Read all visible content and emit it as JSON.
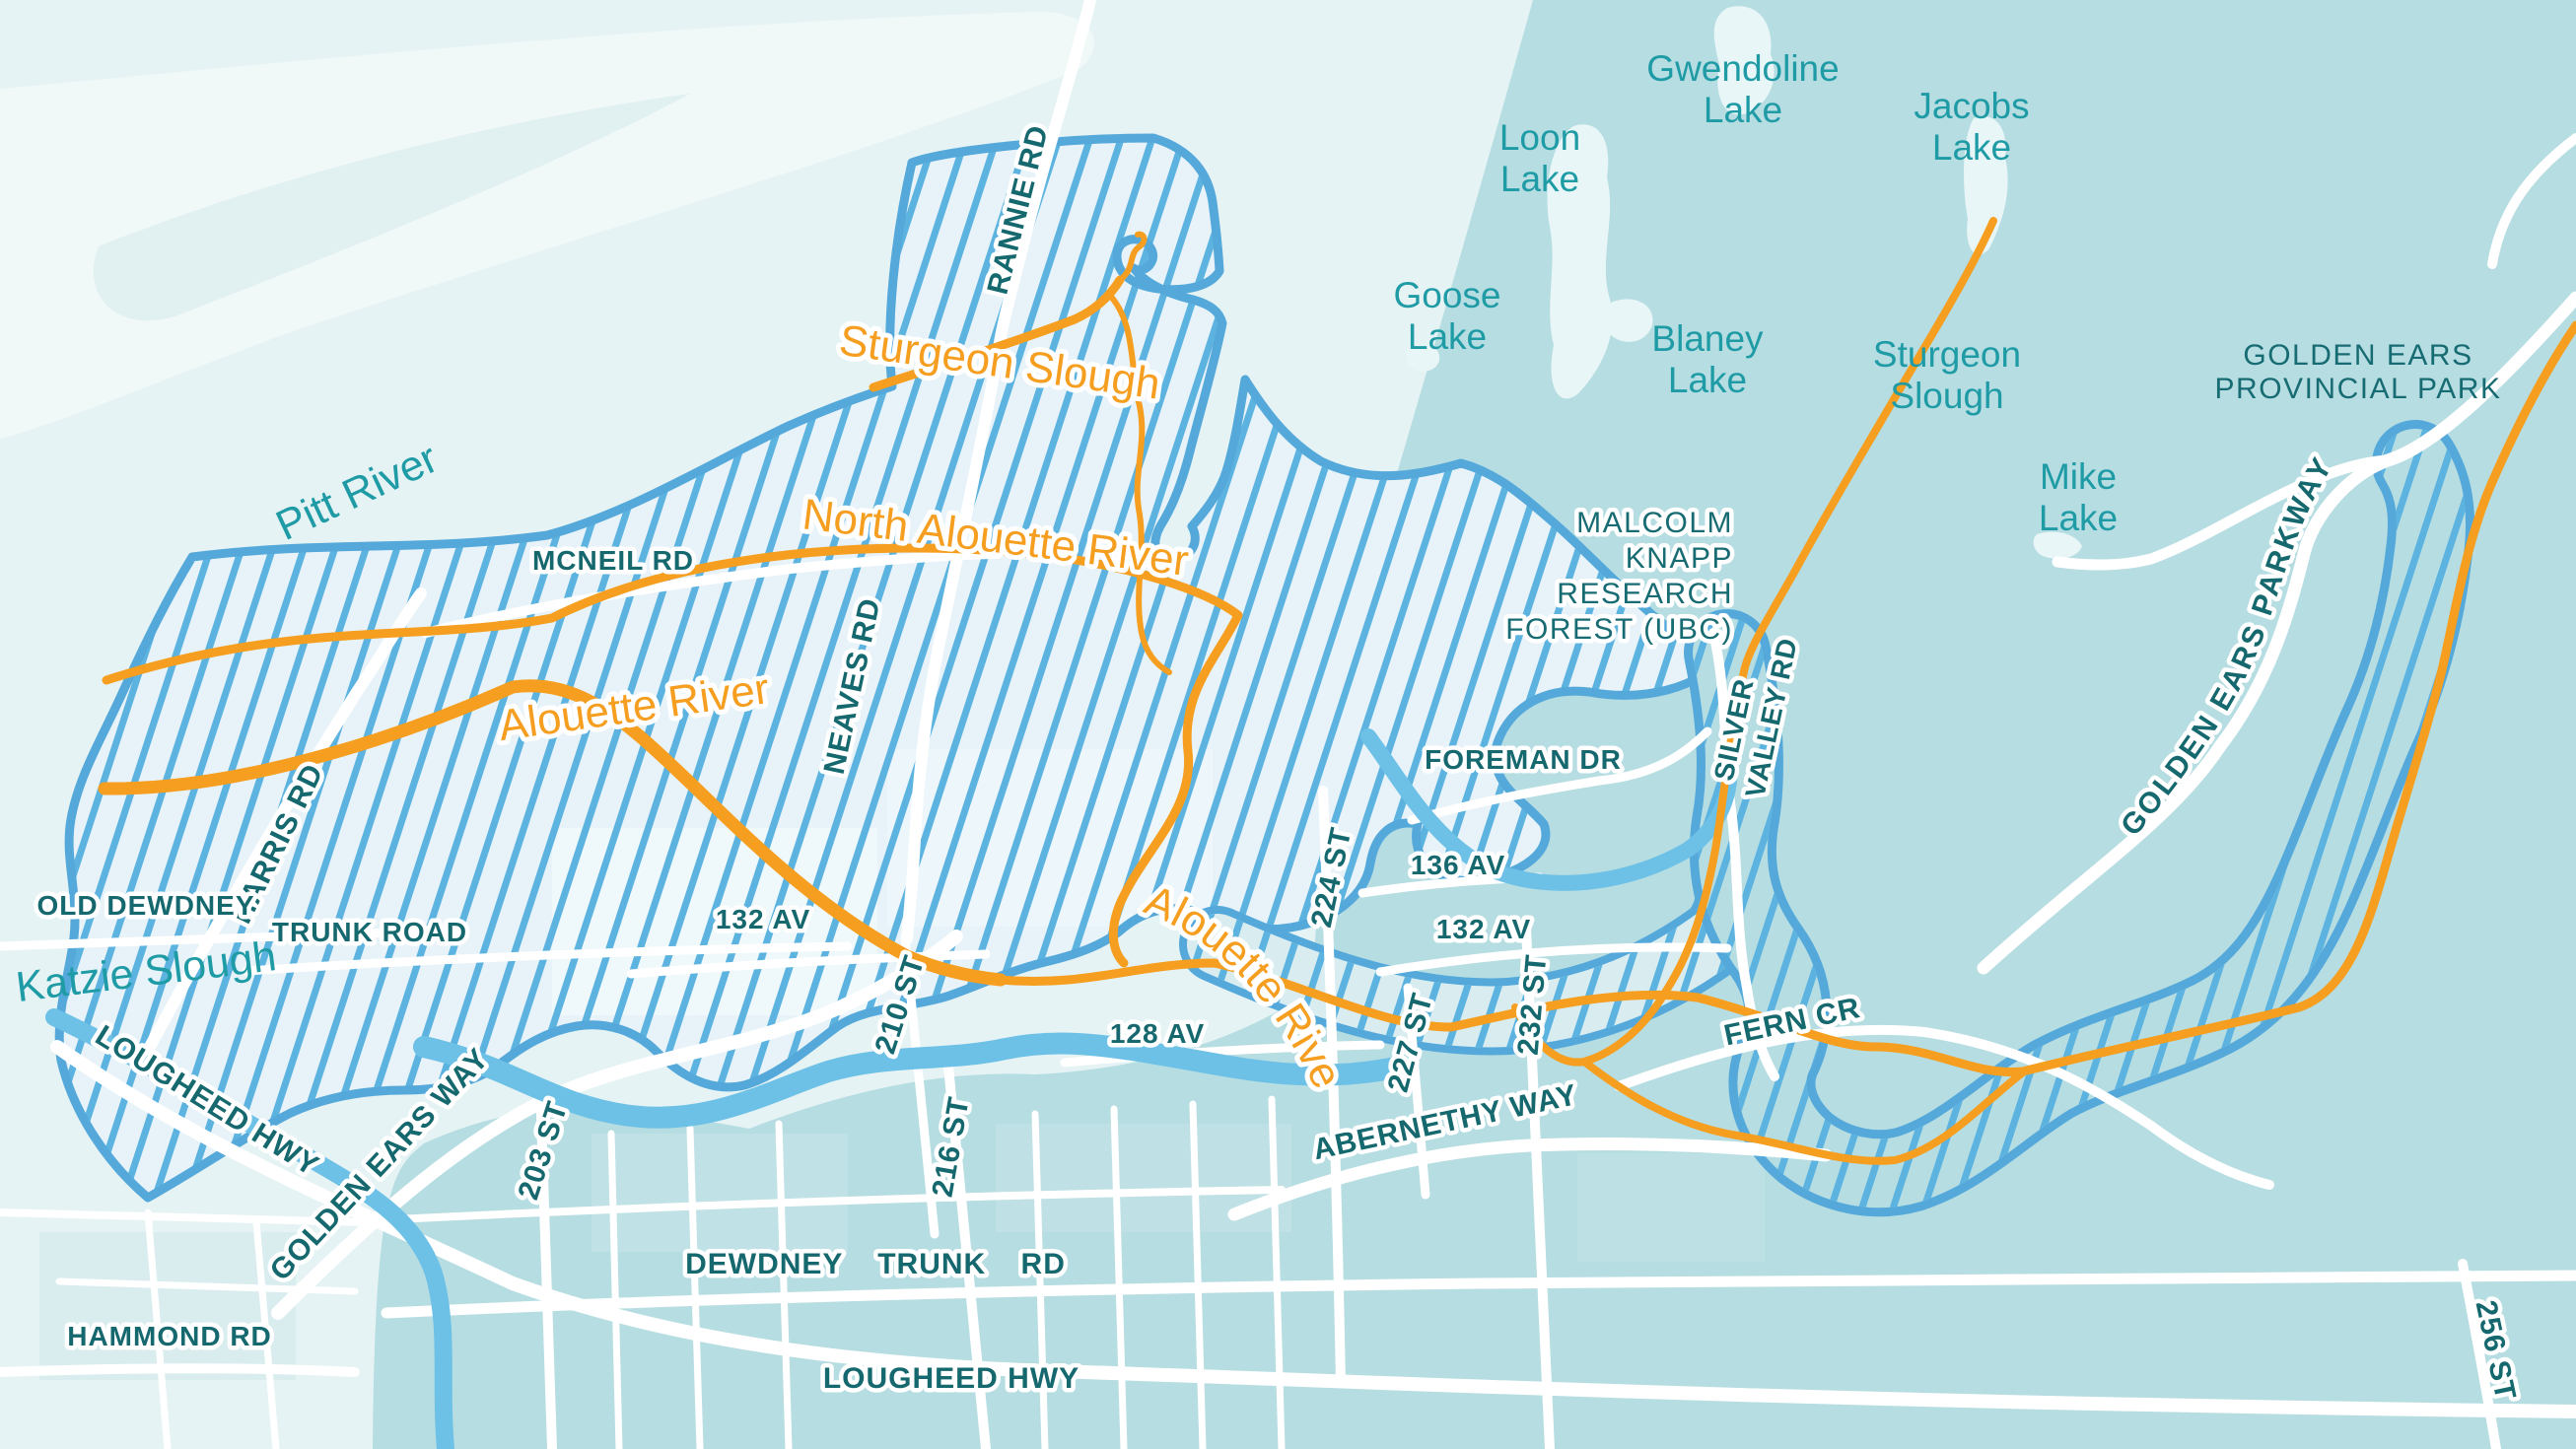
{
  "colors": {
    "zone_dark_teal": "#b6dde2",
    "zone_pale": "#e6f3f4",
    "pitt_river_water": "#f0f8f8",
    "watershed_fill": "#e8f3f9",
    "watershed_hatch_blue": "#5cb3e0",
    "watershed_border_blue": "#55a9da",
    "water_channel_blue": "#6ec1e6",
    "river_orange": "#f59e20",
    "road_white": "#ffffff",
    "lake_label_teal": "#1f9ba6",
    "road_label_dark_teal": "#15686e"
  },
  "water_labels": [
    {
      "id": "gwendoline-lake",
      "line1": "Gwendoline",
      "line2": "Lake"
    },
    {
      "id": "jacobs-lake",
      "line1": "Jacobs",
      "line2": "Lake"
    },
    {
      "id": "loon-lake",
      "line1": "Loon",
      "line2": "Lake"
    },
    {
      "id": "goose-lake",
      "line1": "Goose",
      "line2": "Lake"
    },
    {
      "id": "blaney-lake",
      "line1": "Blaney",
      "line2": "Lake"
    },
    {
      "id": "mike-lake",
      "line1": "Mike",
      "line2": "Lake"
    },
    {
      "id": "sturgeon-slough-east",
      "line1": "Sturgeon",
      "line2": "Slough"
    },
    {
      "id": "pitt-river",
      "line1": "Pitt River",
      "line2": ""
    },
    {
      "id": "katzie-slough",
      "line1": "Katzie Slough",
      "line2": ""
    }
  ],
  "river_labels": [
    {
      "id": "sturgeon-slough-west",
      "text": "Sturgeon Slough"
    },
    {
      "id": "north-alouette-river",
      "text": "North Alouette River"
    },
    {
      "id": "alouette-river-west",
      "text": "Alouette River"
    },
    {
      "id": "alouette-river-south",
      "text": "Alouette River"
    }
  ],
  "road_labels": [
    {
      "id": "rannie-rd",
      "text": "RANNIE RD"
    },
    {
      "id": "mcneil-rd",
      "text": "MCNEIL RD"
    },
    {
      "id": "neaves-rd",
      "text": "NEAVES RD"
    },
    {
      "id": "harris-rd",
      "text": "HARRIS RD"
    },
    {
      "id": "old-dewdney",
      "text": "OLD DEWDNEY"
    },
    {
      "id": "trunk-road",
      "text": "TRUNK ROAD"
    },
    {
      "id": "lougheed-hwy-nw",
      "text": "LOUGHEED HWY"
    },
    {
      "id": "golden-ears-way",
      "text": "GOLDEN EARS WAY"
    },
    {
      "id": "203-st",
      "text": "203 ST"
    },
    {
      "id": "hammond-rd",
      "text": "HAMMOND RD"
    },
    {
      "id": "dewdney-trunk-rd",
      "text": "DEWDNEY TRUNK RD"
    },
    {
      "id": "lougheed-hwy-s",
      "text": "LOUGHEED HWY"
    },
    {
      "id": "216-st",
      "text": "216 ST"
    },
    {
      "id": "210-st",
      "text": "210 ST"
    },
    {
      "id": "132-av-w",
      "text": "132 AV"
    },
    {
      "id": "128-av",
      "text": "128 AV"
    },
    {
      "id": "224-st",
      "text": "224 ST"
    },
    {
      "id": "227-st",
      "text": "227 ST"
    },
    {
      "id": "232-st",
      "text": "232 ST"
    },
    {
      "id": "abernethy-way",
      "text": "ABERNETHY WAY"
    },
    {
      "id": "132-av-e",
      "text": "132 AV"
    },
    {
      "id": "136-av",
      "text": "136 AV"
    },
    {
      "id": "foreman-dr",
      "text": "FOREMAN DR"
    },
    {
      "id": "silver-valley-rd-line1",
      "text": "SILVER"
    },
    {
      "id": "silver-valley-rd-line2",
      "text": "VALLEY RD"
    },
    {
      "id": "fern-cr",
      "text": "FERN CR"
    },
    {
      "id": "golden-ears-parkway",
      "text": "GOLDEN EARS PARKWAY"
    },
    {
      "id": "256-st",
      "text": "256 ST"
    }
  ],
  "area_labels": [
    {
      "id": "golden-ears-provincial-park",
      "line1": "GOLDEN EARS",
      "line2": "PROVINCIAL PARK"
    },
    {
      "id": "malcolm-knapp-research-forest",
      "line1": "MALCOLM",
      "line2": "KNAPP",
      "line3": "RESEARCH",
      "line4": "FOREST (UBC)"
    }
  ]
}
